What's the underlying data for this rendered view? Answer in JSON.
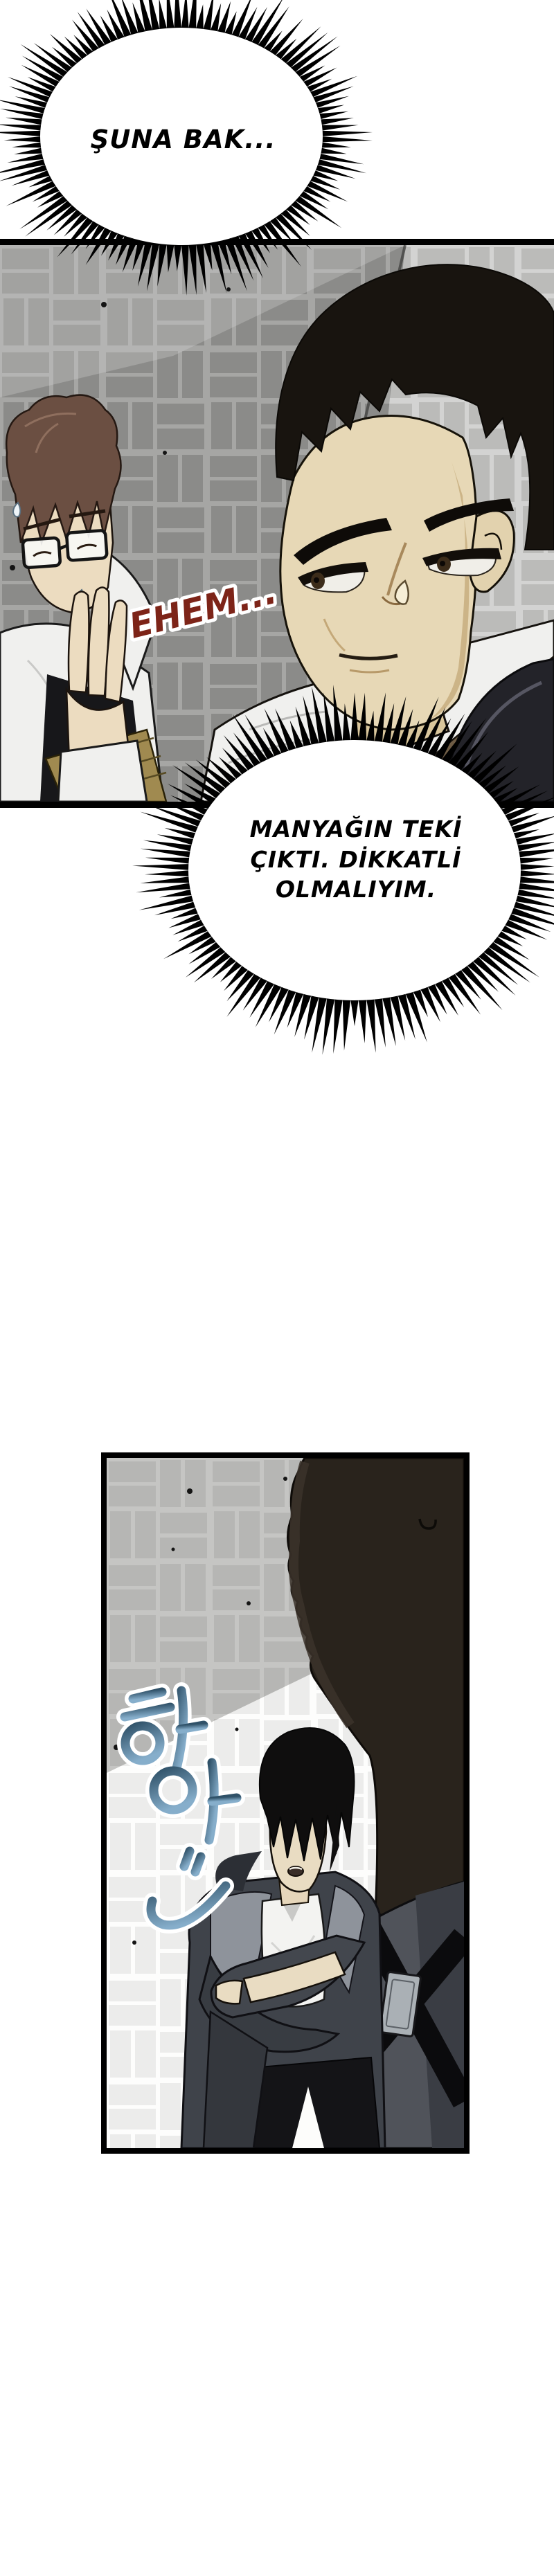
{
  "page": {
    "kind": "webtoon page",
    "paper_color": "#ffffff",
    "ink_color": "#000000"
  },
  "bubbles": {
    "top": {
      "text": "ŞUNA BAK..."
    },
    "thought": {
      "line1": "MANYAĞIN TEKİ",
      "line2": "ÇIKTI. DİKKATLİ",
      "line3": "OLMALIYIM."
    }
  },
  "sfx": {
    "ehem": {
      "text": "EHEM...",
      "color": "#7d2418",
      "outline": "#ffffff"
    },
    "sigh": {
      "text": "하아",
      "color_top": "#2f5168",
      "color_bottom": "#86aecb",
      "outline": "#ffffff"
    }
  },
  "palette": {
    "tile_brick_dark_wall": "#a6a6a4",
    "tile_grout_dark_wall": "#c6c6c4",
    "tile_brick_light_wall": "#dddddb",
    "tile_grout_light_wall": "#fbfbf9",
    "skin": "#e7d8b6",
    "hair_black": "#18140f",
    "hair_brown": "#6b4f42",
    "shirt_white": "#f0f0ee",
    "strap_brown": "#6e5c45",
    "pauldron_dark": "#232329",
    "silhouette_dark": "#29231c",
    "jacket_gray": "#4e5158"
  }
}
